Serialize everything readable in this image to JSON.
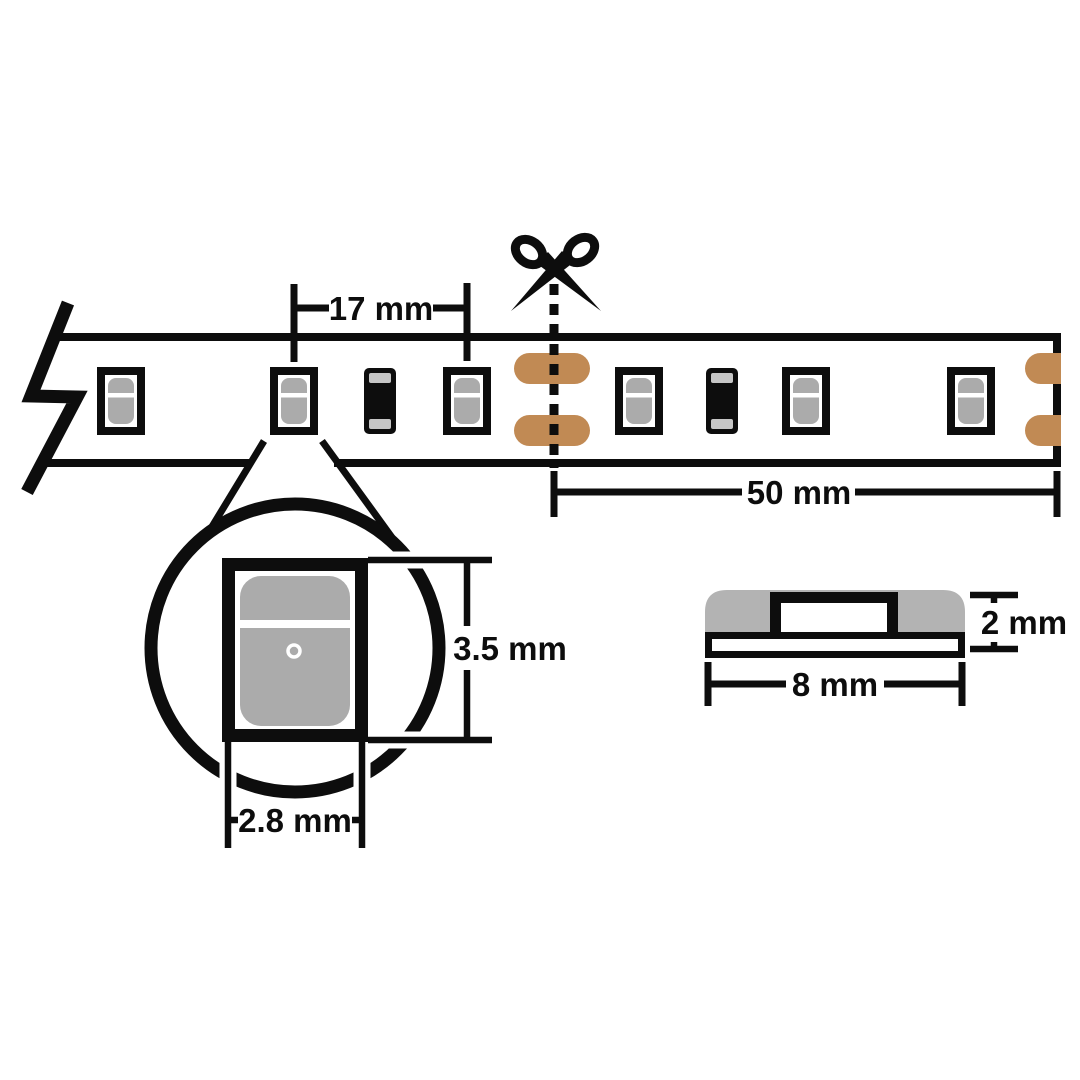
{
  "colors": {
    "line": "#0d0d0d",
    "copper": "#c18a54",
    "led_gray": "#ababab",
    "cap_gray": "#c6c6c6",
    "body_gray": "#b3b3b3",
    "background": "#ffffff"
  },
  "strip_view": {
    "led_count": 6,
    "resistor_count": 2,
    "pitch_label": "17 mm",
    "segment_label": "50 mm"
  },
  "led_detail": {
    "height_label": "3.5 mm",
    "width_label": "2.8 mm"
  },
  "cross_section": {
    "width_label": "8 mm",
    "thickness_label": "2 mm"
  }
}
